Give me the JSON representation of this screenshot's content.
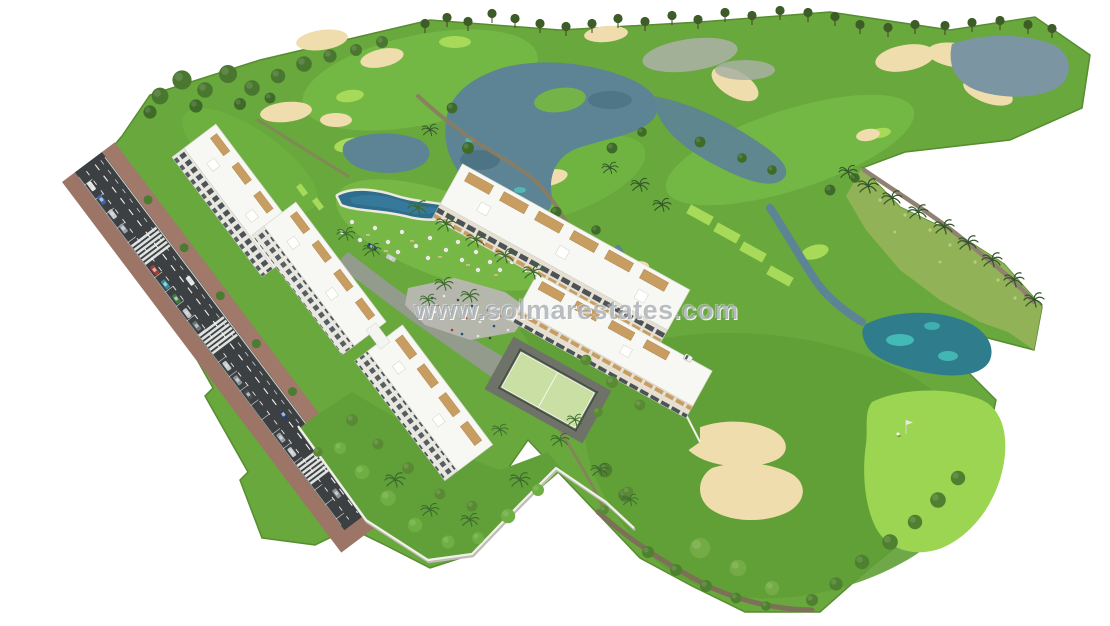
{
  "scene": {
    "type": "aerial-3d-render",
    "subject": "New build apartment complex beside a golf course resort",
    "elements": [
      "golf fairways",
      "lakes",
      "sand bunkers",
      "palm trees",
      "white apartment blocks",
      "pool with umbrellas",
      "paddle court",
      "plaza with people",
      "road with parking and crosswalks",
      "putting green with flag"
    ]
  },
  "watermark": {
    "text": "www.solmarestates.com"
  },
  "palette": {
    "grass": "#68a83c",
    "fairway_light": "#7cc24a",
    "green_bright": "#a6da58",
    "scrub": "#9ab45c",
    "sand": "#f0ddad",
    "water": "#5d8494",
    "water_teal": "#46c4bd",
    "pool": "#2f6d8f",
    "road": "#3d4043",
    "sidewalk": "#9c7566",
    "building": "#f7f7f3",
    "wood_trim": "#c79d62",
    "tree_dark": "#3e5c28",
    "watermark_gray": "#808890"
  }
}
